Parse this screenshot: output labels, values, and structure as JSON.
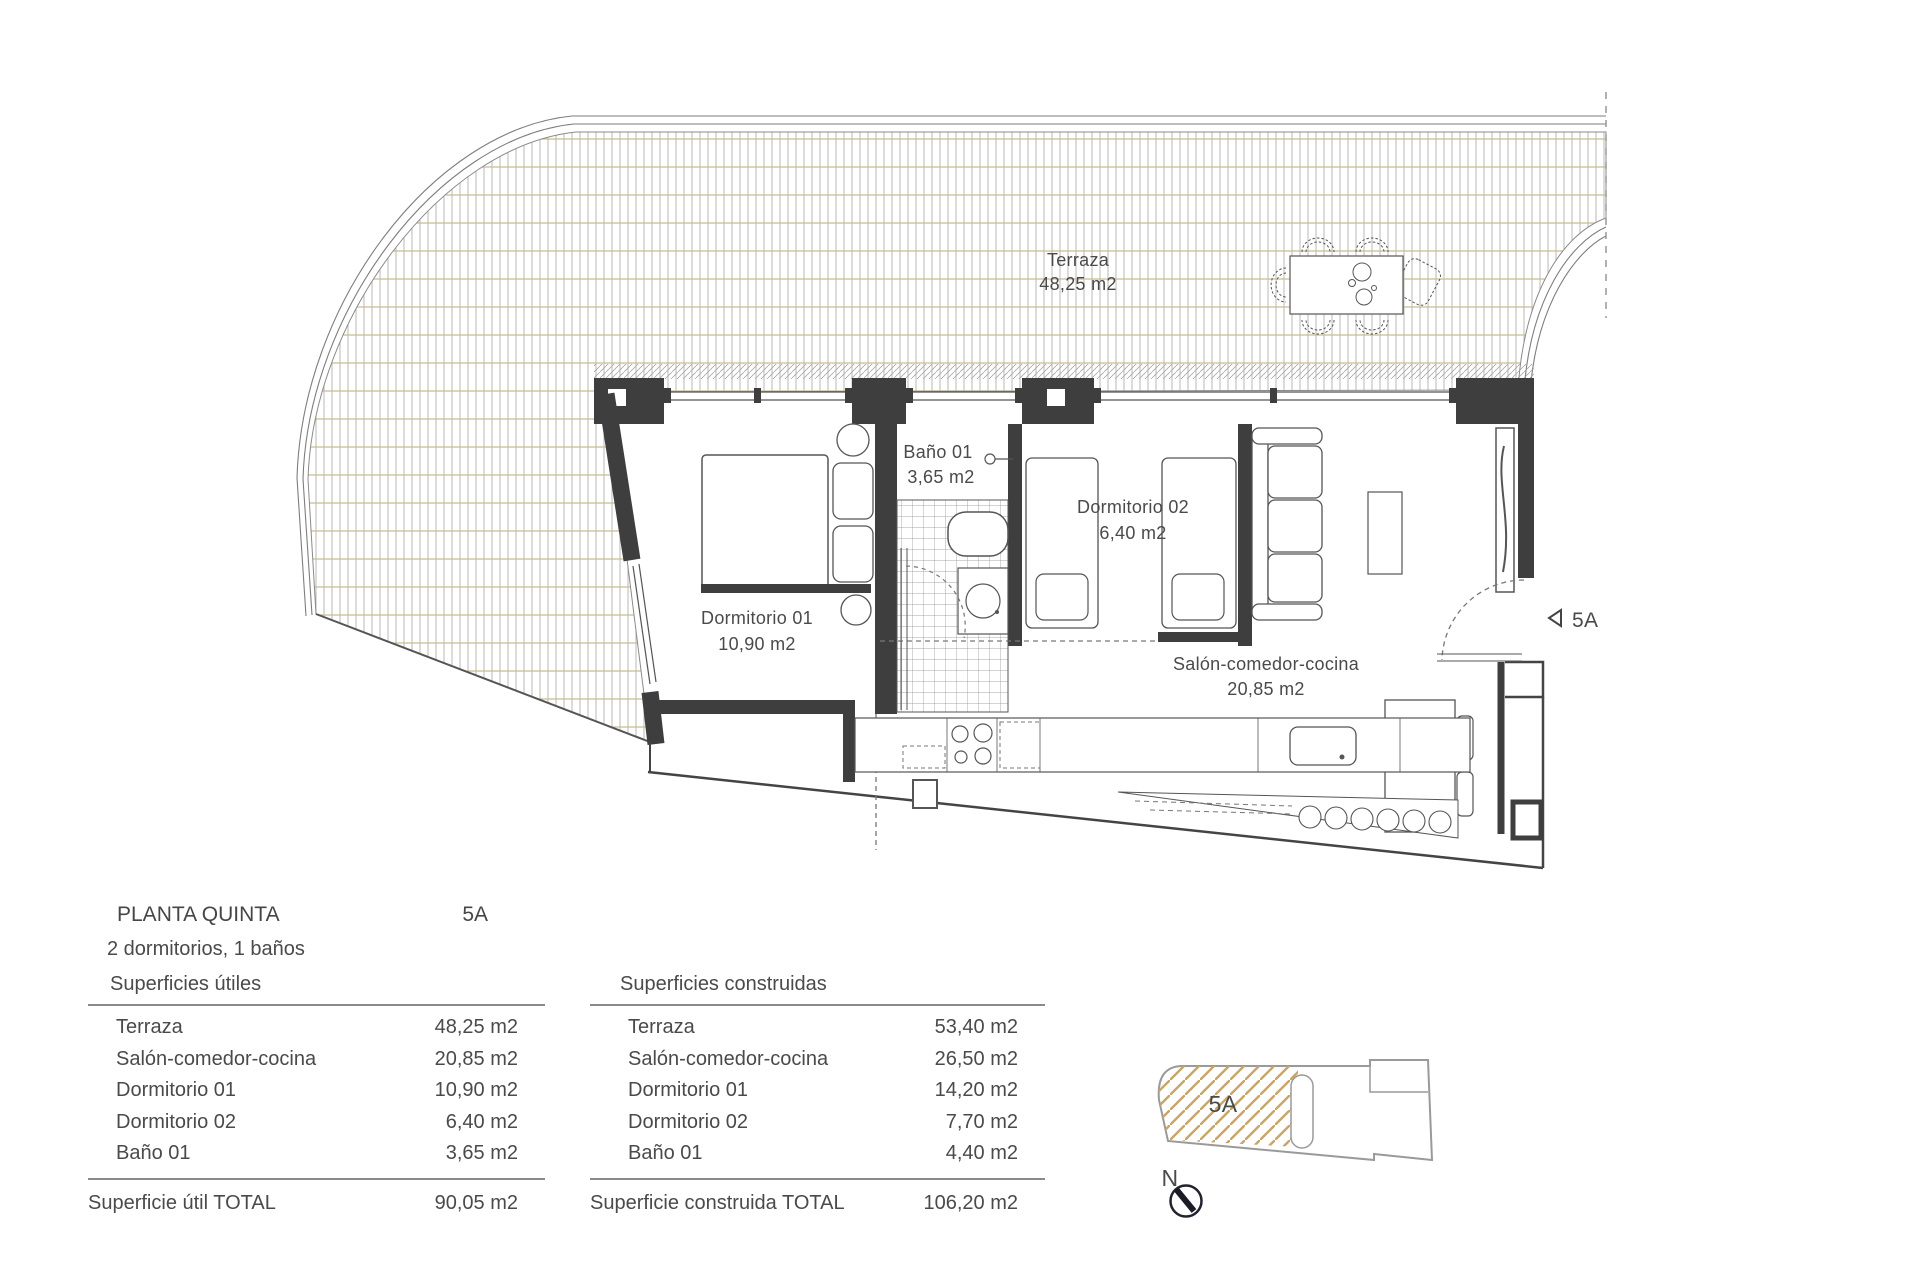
{
  "plan": {
    "terrace": {
      "name": "Terraza",
      "area": "48,25 m2"
    },
    "bathroom": {
      "name": "Baño 01",
      "area": "3,65 m2"
    },
    "bedroom1": {
      "name": "Dormitorio 01",
      "area": "10,90 m2"
    },
    "bedroom2": {
      "name": "Dormitorio 02",
      "area": "6,40 m2"
    },
    "living": {
      "name": "Salón-comedor-cocina",
      "area": "20,85 m2"
    },
    "entrance_label": "5A"
  },
  "summary": {
    "floor_title": "PLANTA QUINTA",
    "unit": "5A",
    "config": "2 dormitorios, 1 baños",
    "useful": {
      "header": "Superficies útiles",
      "rows": [
        {
          "label": "Terraza",
          "value": "48,25 m2"
        },
        {
          "label": "Salón-comedor-cocina",
          "value": "20,85 m2"
        },
        {
          "label": "Dormitorio 01",
          "value": "10,90 m2"
        },
        {
          "label": "Dormitorio 02",
          "value": "6,40 m2"
        },
        {
          "label": "Baño 01",
          "value": "3,65 m2"
        }
      ],
      "total_label": "Superficie útil TOTAL",
      "total_value": "90,05 m2"
    },
    "built": {
      "header": "Superficies  construidas",
      "rows": [
        {
          "label": "Terraza",
          "value": "53,40 m2"
        },
        {
          "label": "Salón-comedor-cocina",
          "value": "26,50 m2"
        },
        {
          "label": "Dormitorio 01",
          "value": "14,20 m2"
        },
        {
          "label": "Dormitorio 02",
          "value": "7,70 m2"
        },
        {
          "label": "Baño 01",
          "value": "4,40 m2"
        }
      ],
      "total_label": "Superficie construida TOTAL",
      "total_value": "106,20 m2"
    }
  },
  "keyplan": {
    "unit": "5A",
    "north_label": "N"
  },
  "colors": {
    "wall": "#3e3e3e",
    "line": "#555555",
    "deck_plank": "#b3b1ac",
    "deck_joint": "#c9b893",
    "hatch_gold": "#c8a568",
    "text": "#4a4a4a"
  }
}
